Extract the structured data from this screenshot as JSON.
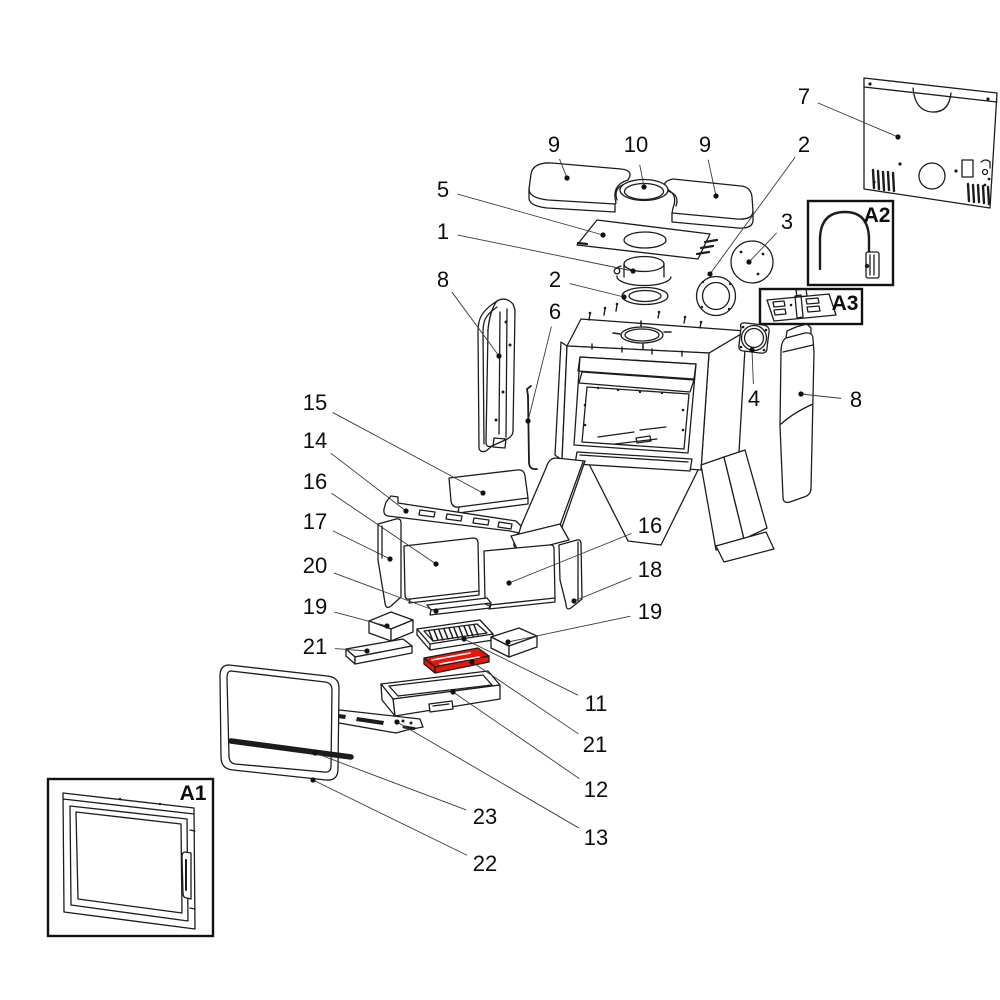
{
  "diagram": {
    "kind": "exploded-parts-diagram",
    "colors": {
      "background": "#ffffff",
      "line": "#1c1c1c",
      "label": "#0d0d0d",
      "highlight": "#e8150b"
    },
    "highlighted_callout": "21",
    "callouts": [
      {
        "label": "7",
        "x": 804,
        "y": 104,
        "tx": 898,
        "ty": 137
      },
      {
        "label": "2",
        "x": 804,
        "y": 152,
        "tx": 710,
        "ty": 274
      },
      {
        "label": "3",
        "x": 787,
        "y": 229,
        "tx": 749,
        "ty": 262
      },
      {
        "label": "9",
        "x": 554,
        "y": 152,
        "tx": 567,
        "ty": 178
      },
      {
        "label": "10",
        "x": 636,
        "y": 152,
        "tx": 644,
        "ty": 187
      },
      {
        "label": "9",
        "x": 705,
        "y": 152,
        "tx": 716,
        "ty": 196
      },
      {
        "label": "5",
        "x": 443,
        "y": 197,
        "tx": 603,
        "ty": 235
      },
      {
        "label": "1",
        "x": 443,
        "y": 239,
        "tx": 633,
        "ty": 271
      },
      {
        "label": "8",
        "x": 443,
        "y": 287,
        "tx": 499,
        "ty": 356
      },
      {
        "label": "2",
        "x": 555,
        "y": 287,
        "tx": 624,
        "ty": 297
      },
      {
        "label": "6",
        "x": 555,
        "y": 319,
        "tx": 528,
        "ty": 421
      },
      {
        "label": "4",
        "x": 754,
        "y": 406,
        "tx": 752,
        "ty": 350
      },
      {
        "label": "8",
        "x": 856,
        "y": 407,
        "tx": 801,
        "ty": 394
      },
      {
        "label": "15",
        "x": 315,
        "y": 410,
        "tx": 483,
        "ty": 493
      },
      {
        "label": "14",
        "x": 315,
        "y": 448,
        "tx": 406,
        "ty": 511
      },
      {
        "label": "16",
        "x": 315,
        "y": 489,
        "tx": 436,
        "ty": 564
      },
      {
        "label": "17",
        "x": 315,
        "y": 529,
        "tx": 390,
        "ty": 559
      },
      {
        "label": "20",
        "x": 315,
        "y": 573,
        "tx": 436,
        "ty": 611
      },
      {
        "label": "19",
        "x": 315,
        "y": 614,
        "tx": 387,
        "ty": 626
      },
      {
        "label": "21",
        "x": 315,
        "y": 654,
        "tx": 367,
        "ty": 651
      },
      {
        "label": "16",
        "x": 650,
        "y": 533,
        "tx": 509,
        "ty": 583
      },
      {
        "label": "18",
        "x": 650,
        "y": 577,
        "tx": 574,
        "ty": 601
      },
      {
        "label": "19",
        "x": 650,
        "y": 619,
        "tx": 508,
        "ty": 642
      },
      {
        "label": "11",
        "x": 596,
        "y": 711,
        "tx": 464,
        "ty": 639
      },
      {
        "label": "21",
        "x": 595,
        "y": 752,
        "tx": 472,
        "ty": 662
      },
      {
        "label": "12",
        "x": 596,
        "y": 797,
        "tx": 453,
        "ty": 692
      },
      {
        "label": "13",
        "x": 596,
        "y": 845,
        "tx": 397,
        "ty": 722
      },
      {
        "label": "23",
        "x": 485,
        "y": 824,
        "tx": 315,
        "ty": 753
      },
      {
        "label": "22",
        "x": 485,
        "y": 871,
        "tx": 313,
        "ty": 780
      }
    ],
    "assemblies": [
      {
        "label": "A1",
        "x": 193,
        "y": 800
      },
      {
        "label": "A2",
        "x": 877,
        "y": 222
      },
      {
        "label": "A3",
        "x": 845,
        "y": 310
      }
    ]
  }
}
